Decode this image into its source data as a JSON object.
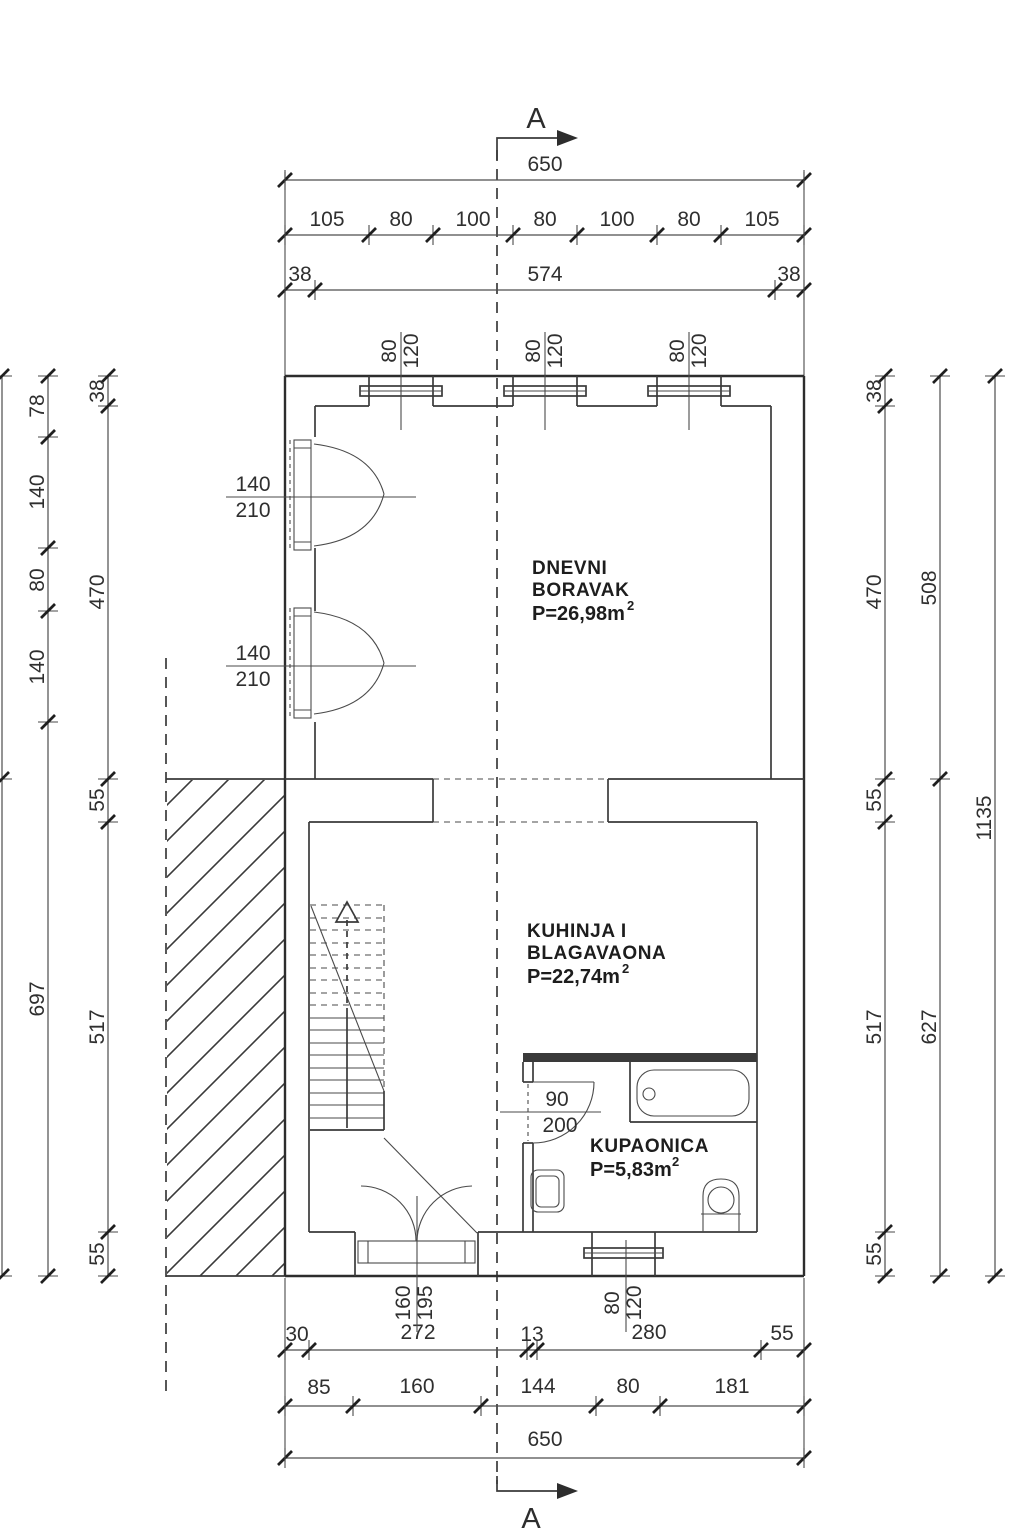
{
  "drawing": {
    "type": "architectural floor plan",
    "section_label_top": "A",
    "section_label_bottom": "A"
  },
  "colors": {
    "ink": "#2d2d2d",
    "background": "#ffffff"
  },
  "rooms": [
    {
      "line1": "DNEVNI",
      "line2": "BORAVAK",
      "area": "P=26,98m",
      "area_sup": "2"
    },
    {
      "line1": "KUHINJA I",
      "line2": "BLAGAVAONA",
      "area": "P=22,74m",
      "area_sup": "2"
    },
    {
      "line1": "KUPAONICA",
      "line2": "",
      "area": "P=5,83m",
      "area_sup": "2"
    }
  ],
  "dimensions": {
    "top": {
      "total": "650",
      "segments": [
        "105",
        "80",
        "100",
        "80",
        "100",
        "80",
        "105"
      ],
      "wall_row": [
        "38",
        "574",
        "38"
      ]
    },
    "bottom": {
      "row1": [
        "30",
        "272",
        "13",
        "280",
        "55"
      ],
      "row2": [
        "85",
        "160",
        "144",
        "80",
        "181"
      ],
      "total": "650"
    },
    "left": {
      "inner_col": [
        "78",
        "140",
        "80",
        "140",
        "697"
      ],
      "outer_col": [
        "38",
        "470",
        "55",
        "517",
        "55"
      ]
    },
    "right": {
      "col1": [
        "38",
        "470",
        "55",
        "517",
        "55"
      ],
      "col2": [
        "508",
        "627"
      ],
      "col3": "1135"
    }
  },
  "openings": {
    "top_windows": [
      {
        "w": "80",
        "h": "120"
      },
      {
        "w": "80",
        "h": "120"
      },
      {
        "w": "80",
        "h": "120"
      }
    ],
    "balcony_doors": [
      {
        "w": "140",
        "h": "210"
      },
      {
        "w": "140",
        "h": "210"
      }
    ],
    "bathroom_door": {
      "w": "90",
      "h": "200"
    },
    "entrance_door": {
      "w": "160",
      "h": "195"
    },
    "bathroom_window": {
      "w": "80",
      "h": "120"
    }
  }
}
